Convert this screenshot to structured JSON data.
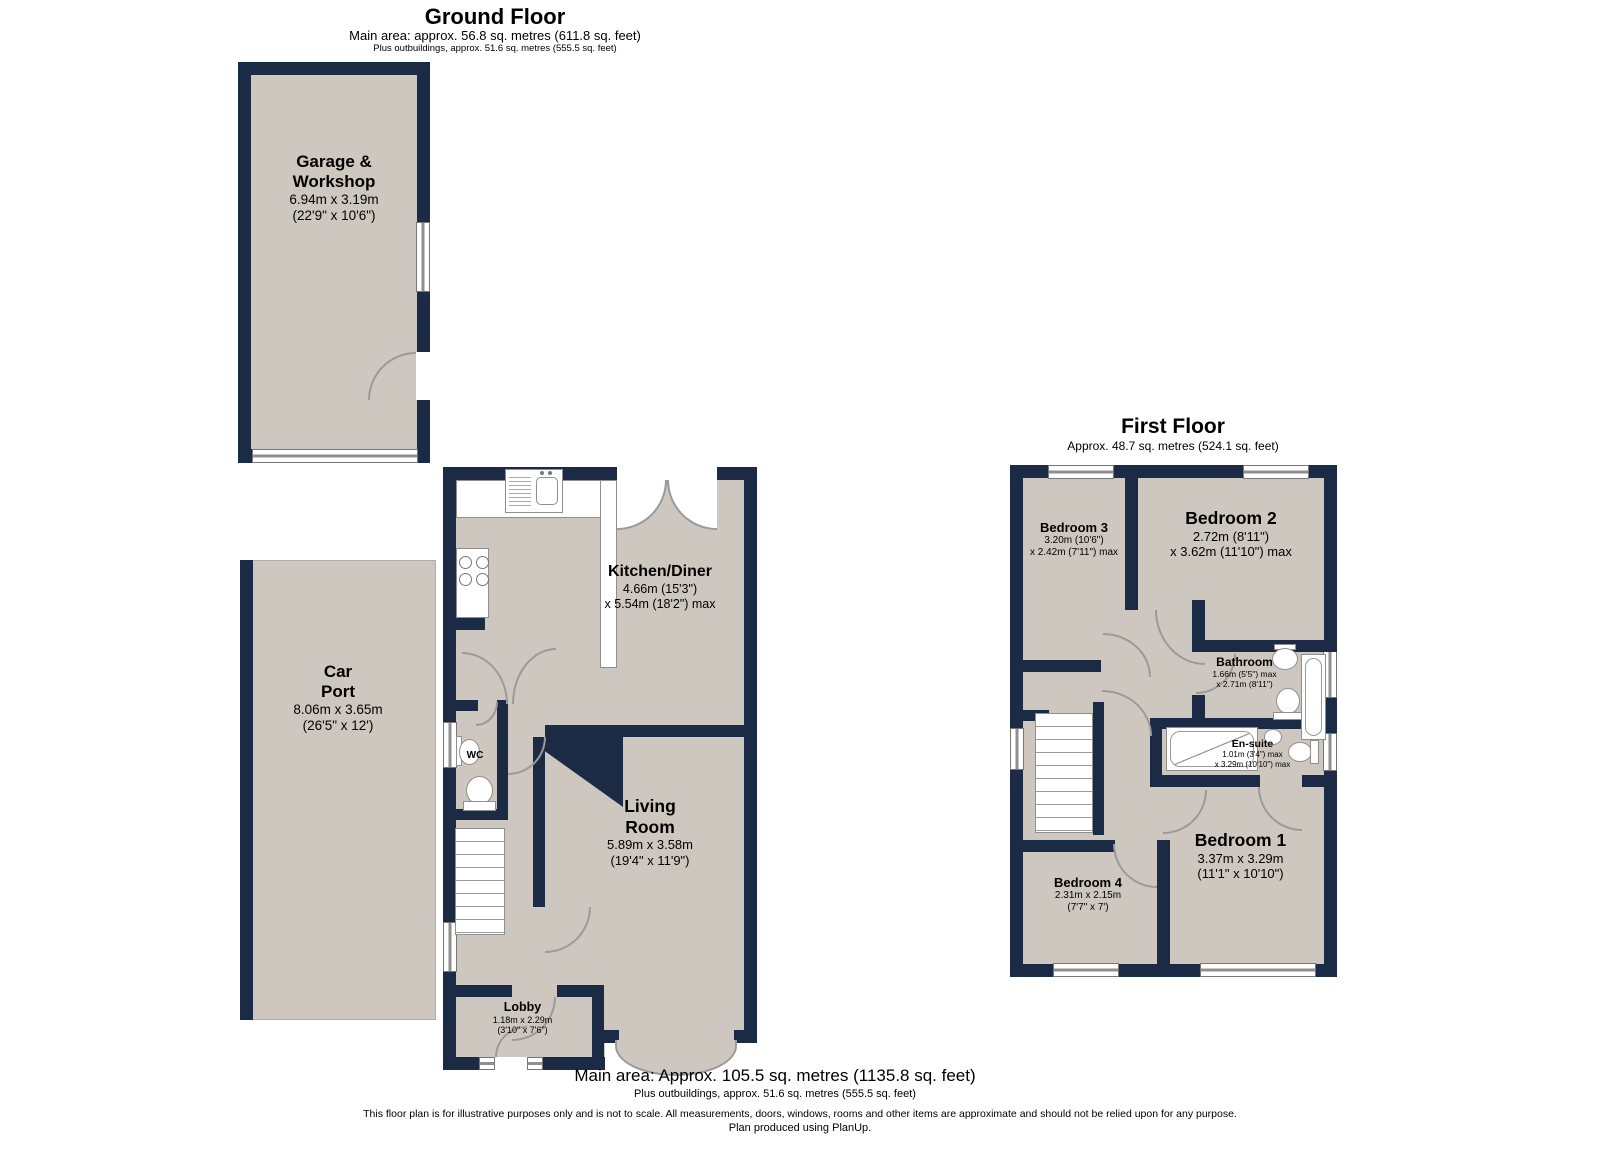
{
  "colors": {
    "wall": "#1b2a45",
    "floor": "#cec7bf",
    "line": "#9a9a9a"
  },
  "ground_floor": {
    "title": "Ground Floor",
    "area_line1": "Main area: approx. 56.8 sq. metres (611.8 sq. feet)",
    "area_line2": "Plus outbuildings, approx. 51.6 sq. metres (555.5 sq. feet)",
    "rooms": {
      "garage": {
        "name1": "Garage &",
        "name2": "Workshop",
        "metric": "6.94m x 3.19m",
        "imperial": "(22'9\" x 10'6\")"
      },
      "carport": {
        "name1": "Car",
        "name2": "Port",
        "metric": "8.06m x 3.65m",
        "imperial": "(26'5\" x 12')"
      },
      "kitchen": {
        "name": "Kitchen/Diner",
        "metric": "4.66m (15'3\")",
        "imperial": "x 5.54m (18'2\") max"
      },
      "wc": {
        "name": "WC"
      },
      "living": {
        "name1": "Living",
        "name2": "Room",
        "metric": "5.89m x 3.58m",
        "imperial": "(19'4\" x 11'9\")"
      },
      "lobby": {
        "name": "Lobby",
        "metric": "1.18m x 2.29m",
        "imperial": "(3'10\" x 7'6\")"
      }
    }
  },
  "first_floor": {
    "title": "First Floor",
    "area_line1": "Approx. 48.7 sq. metres (524.1 sq. feet)",
    "rooms": {
      "bedroom3": {
        "name": "Bedroom 3",
        "metric": "3.20m (10'6\")",
        "imperial": "x 2.42m (7'11\") max"
      },
      "bedroom2": {
        "name": "Bedroom 2",
        "metric": "2.72m (8'11\")",
        "imperial": "x 3.62m (11'10\") max"
      },
      "bathroom": {
        "name": "Bathroom",
        "metric": "1.66m (5'5\") max",
        "imperial": "x 2.71m (8'11\")"
      },
      "ensuite": {
        "name": "En-suite",
        "metric": "1.01m (3'4\") max",
        "imperial": "x 3.29m (10'10\") max"
      },
      "bedroom1": {
        "name": "Bedroom 1",
        "metric": "3.37m x 3.29m",
        "imperial": "(11'1\" x 10'10\")"
      },
      "bedroom4": {
        "name": "Bedroom 4",
        "metric": "2.31m x 2.15m",
        "imperial": "(7'7\" x 7')"
      }
    }
  },
  "footer": {
    "main_area": "Main area: Approx. 105.5 sq. metres (1135.8 sq. feet)",
    "outbuildings": "Plus outbuildings, approx. 51.6 sq. metres (555.5 sq. feet)",
    "disclaimer": "This floor plan is for illustrative purposes only and is not to scale. All measurements, doors, windows, rooms and other items are approximate and should not be relied upon for any purpose.",
    "produced": "Plan produced using PlanUp."
  }
}
